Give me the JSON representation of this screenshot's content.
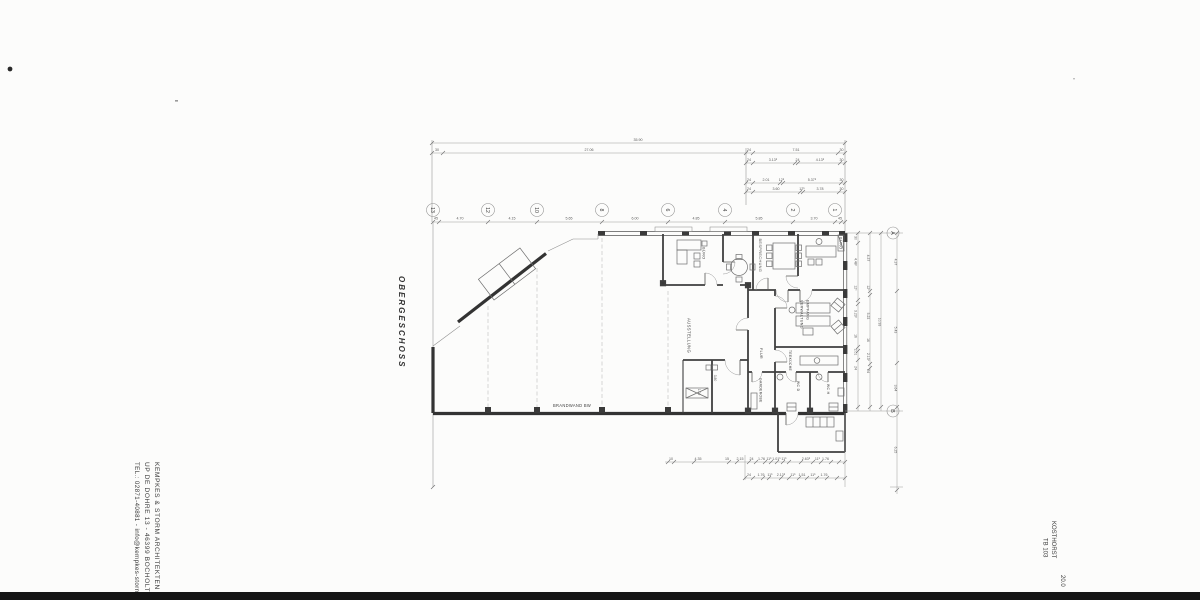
{
  "title_block": {
    "floor_label": "OBERGESCHOSS",
    "architect_line1": "KEMPKES & STORM   ARCHITEKTEN",
    "architect_line2": "UP DE DOHRE 13  -  46399 BOCHOLT",
    "architect_line3": "TEL.: 02871-40881 - info@kempkes-storm.de",
    "project": "KOSTHORST",
    "sheet": "TB 103",
    "scale_note": "20.0"
  },
  "grid": {
    "columns": [
      "13",
      "12",
      "10",
      "8",
      "6",
      "4",
      "2",
      "1"
    ],
    "rows": [
      "A",
      "B"
    ],
    "spacings": [
      "45",
      "4.70",
      "4.15",
      "5.65",
      "6.00",
      "4.85",
      "5.85",
      "3.70",
      "45"
    ]
  },
  "dims": {
    "total": "35.90",
    "row2": [
      "30",
      "27.06",
      "24",
      "7.51",
      "30"
    ],
    "row3": [
      "24",
      "3.13⁵",
      "24",
      "4.13⁵",
      "30"
    ],
    "row4": [
      "24",
      "2.01",
      "12⁵",
      "5.37⁵",
      "30"
    ],
    "row5": [
      "24",
      "3.60",
      "12⁵",
      "3.78",
      "30"
    ],
    "bottom1": [
      "10",
      "4.35",
      "15",
      "2.15",
      "24",
      "1.76",
      "11⁵",
      "1.01⁵",
      "11⁵",
      "2.63⁵",
      "11⁵",
      "1.76"
    ],
    "bottom2": [
      "24",
      "1.76",
      "11⁵",
      "2.13⁵",
      "11⁵",
      "1.51",
      "11⁵",
      "1.76"
    ],
    "right_inner1": [
      "30",
      "4.48⁵",
      "12⁵",
      "3.23⁵",
      "16",
      "2.01",
      "24"
    ],
    "right_inner2": [
      "4.37",
      "12⁵",
      "5.23",
      "16",
      "2.13⁵",
      "24"
    ],
    "right_total": "10.93",
    "right_outer": [
      "4.37",
      "5.43",
      "3.64",
      "6.25"
    ],
    "small_room": [
      "3.80",
      "1.00"
    ]
  },
  "rooms": {
    "ausstellung": "AUSSTELLUNG",
    "buero_left": "BÜRO",
    "besprechung": "BESPRECHUNG",
    "buero_right": "BÜRO",
    "empfang_line1": "EMPFANG",
    "empfang_line2": "VERWALTUNG",
    "flur": "FLUR",
    "garderobe": "GARDEROBE",
    "teekueche": "TEEKÜCHE",
    "wc_d": "WC D",
    "wc_h": "WC H",
    "fire_wall": "BRANDWAND BW"
  }
}
